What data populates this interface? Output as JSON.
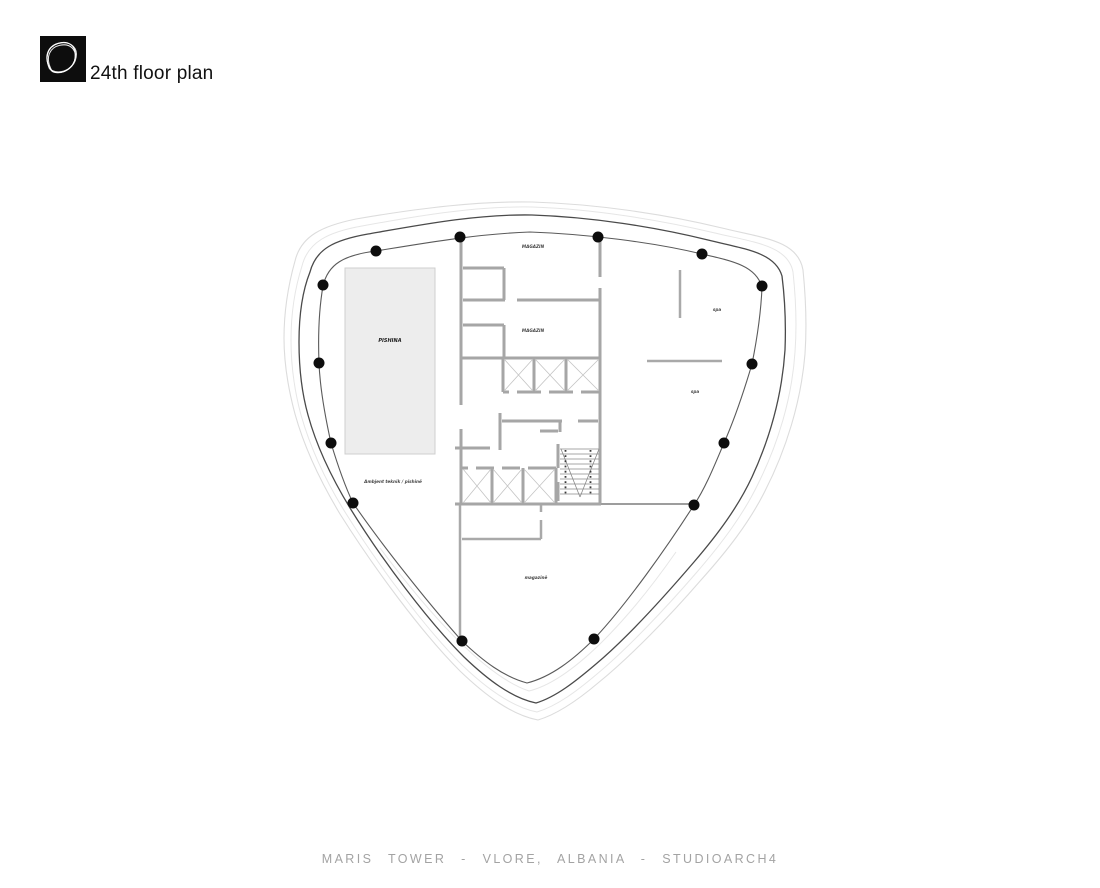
{
  "header": {
    "logo_name": "studioarch4-logo",
    "title": "24th floor plan"
  },
  "plan": {
    "labels": {
      "magazin_upper": "MAGAZIN",
      "magazin_lower": "MAGAZIN",
      "spa_upper": "spa",
      "spa_lower": "spa",
      "pool": "PISHINA",
      "technical": "Ambjent teknik / pishinë",
      "storage_bottom": "magazinë"
    },
    "column_count": 14,
    "colors": {
      "column_black": "#0d0d0d",
      "wall_gray": "#a6a6a6",
      "facade_dark": "#4a4a4a",
      "facade_light": "#dcdcdc",
      "pool_fill": "#ededed",
      "footer_gray": "#a3a3a3"
    }
  },
  "footer": {
    "caption": "MARIS TOWER - VLORE, ALBANIA - STUDIOARCH4"
  }
}
